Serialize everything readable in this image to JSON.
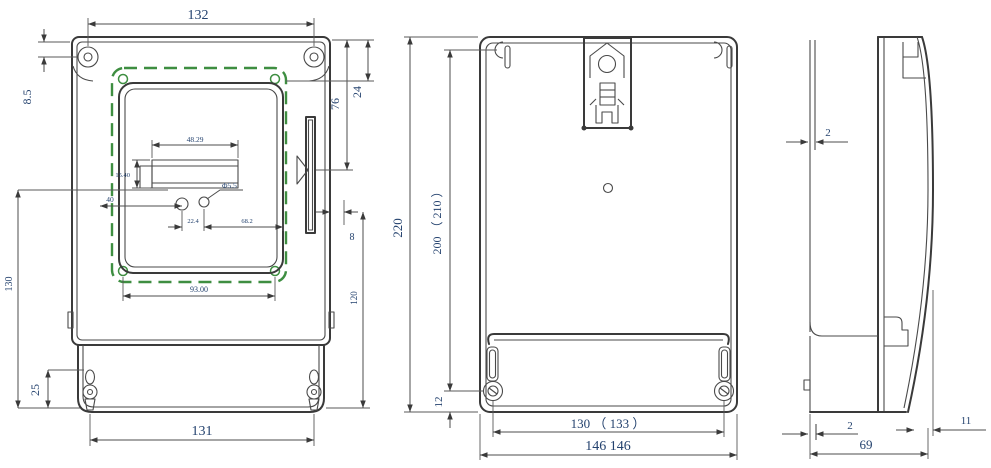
{
  "colors": {
    "line": "#3a3a3a",
    "dimension_text": "#24426e",
    "seal_gasket_green": "#3e8e41"
  },
  "dims": {
    "front": {
      "top_screw_span": "132",
      "top_offset": "8.5",
      "window_top": "76",
      "corner_offset": "24",
      "left_leader": "40",
      "lcd_width": "48.29",
      "lcd_height": "15.40",
      "button_dia": "Φ5.5",
      "button_offset": "22.4",
      "button_span": "68.2",
      "edge_gap": "8",
      "right_height": "120",
      "left_height": "130",
      "bottom_offset": "25",
      "seal_span": "93.00",
      "bottom_screw_span": "131"
    },
    "rear": {
      "height": "220",
      "mount_height": "200 （ 210 ）",
      "screw_bottom_offset": "12",
      "screw_span": "130 （ 133 ）",
      "width": "146 146"
    },
    "side": {
      "top_gap": "2",
      "bottom_gap": "2",
      "depth": "69",
      "front_offset": "11"
    }
  }
}
